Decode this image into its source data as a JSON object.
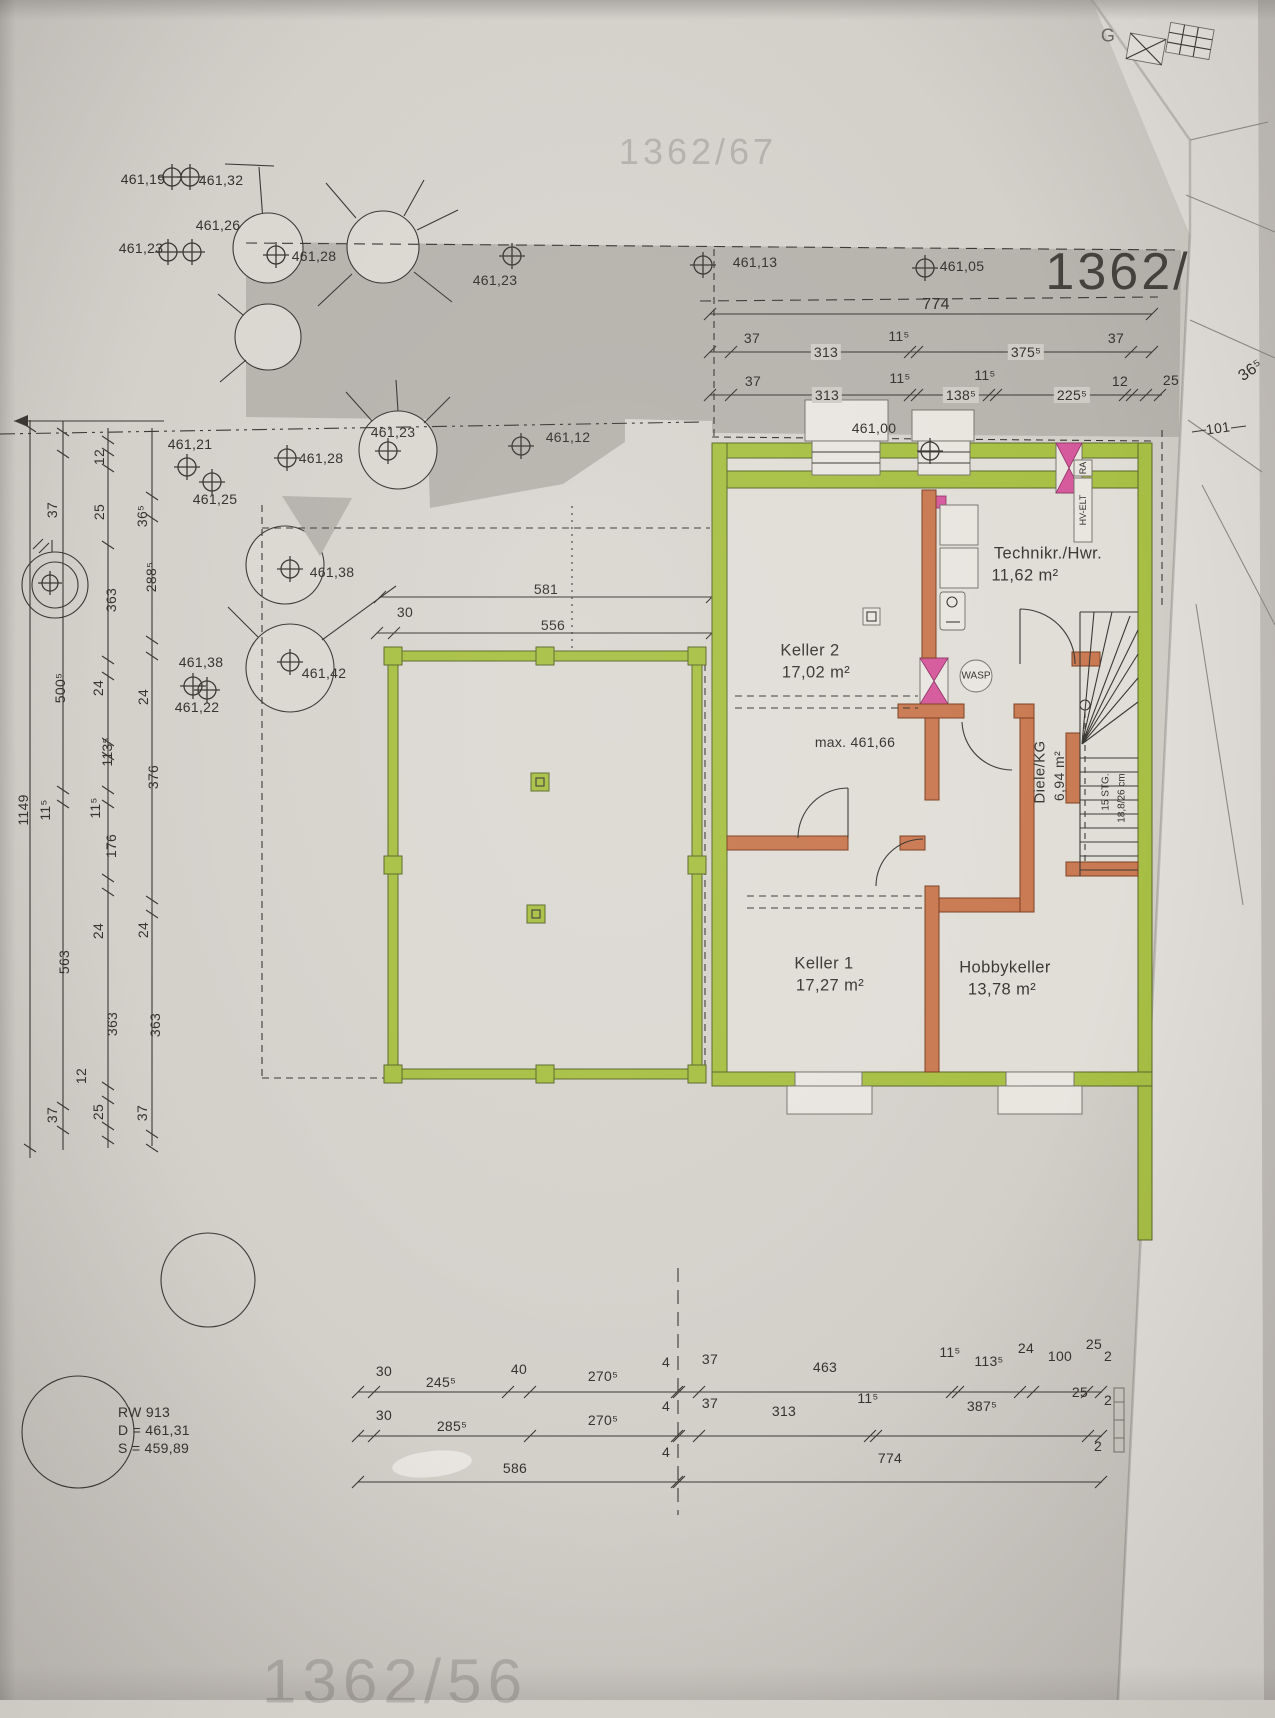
{
  "photo": {
    "corner_letter": "G"
  },
  "plan": {
    "parcel_number": "1362/",
    "ghost_top": "1362/67",
    "ghost_bottom": "1362/56",
    "elevations": [
      "461,19",
      "461,32",
      "461,26",
      "461,23",
      "461,28",
      "461,23",
      "461,13",
      "461,05",
      "461,21",
      "461,28",
      "461,23",
      "461,12",
      "461,00",
      "461,25",
      "461,38",
      "461,38",
      "461,42",
      "461,22"
    ],
    "max_level": "max. 461,66",
    "rooms": [
      {
        "name": "Technikr./Hwr.",
        "area": "11,62 m²"
      },
      {
        "name": "Keller 2",
        "area": "17,02 m²"
      },
      {
        "name": "Keller 1",
        "area": "17,27 m²"
      },
      {
        "name": "Hobbykeller",
        "area": "13,78 m²"
      },
      {
        "name": "Diele/KG",
        "area": "6,94 m²"
      }
    ],
    "stairs": {
      "l1": "15 STG.",
      "l2": "18,8/26 cm"
    },
    "wasp": "WASP",
    "hv_elt": "HV-ELT",
    "ra": "RA",
    "manhole": {
      "l1": "RW 913",
      "l2": "D = 461,31",
      "l3": "S = 459,89"
    },
    "dims": {
      "top_total": [
        "774"
      ],
      "top_row2": [
        "37",
        "313",
        "11⁵",
        "375⁵",
        "37"
      ],
      "top_row3": [
        "37",
        "313",
        "11⁵",
        "138⁵",
        "11⁵",
        "225⁵",
        "12",
        "25"
      ],
      "right": [
        "36⁵",
        "101"
      ],
      "terrace": [
        "581",
        "30",
        "556"
      ],
      "left_col1": [
        "1149"
      ],
      "left_col2": [
        "37",
        "500⁵",
        "11⁵",
        "563",
        "37"
      ],
      "left_col3": [
        "12",
        "25",
        "363",
        "24",
        "113⁵",
        "11⁵",
        "176",
        "24",
        "363",
        "25"
      ],
      "left_col4": [
        "36⁵",
        "288⁵",
        "24",
        "376",
        "24",
        "363",
        "37"
      ],
      "left_extra": [
        "12"
      ],
      "bottom_row1": [
        "30",
        "245⁵",
        "40",
        "270⁵",
        "4",
        "37",
        "463",
        "11⁵",
        "113⁵",
        "24",
        "100",
        "25",
        "2"
      ],
      "bottom_row2": [
        "30",
        "285⁵",
        "270⁵",
        "4",
        "37",
        "313",
        "11⁵",
        "387⁵",
        "25",
        "2"
      ],
      "bottom_row3": [
        "586",
        "4",
        "774",
        "2"
      ]
    }
  }
}
